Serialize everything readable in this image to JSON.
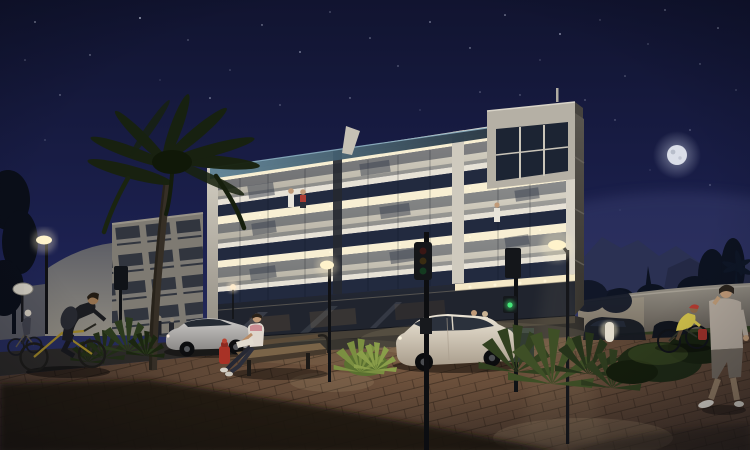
{
  "meta": {
    "type": "architectural-night-render",
    "description": "Night-time 3D visualization of a modern four-storey apartment building with brightly lit balconies above a glass commercial ground floor. A paved plaza in the foreground has a bench, fire hydrant, street lamps, traffic lights, palm tree, shrubs, two parked sedans, cyclists and pedestrians. Deep navy sky with stars and a full moon upper right.",
    "time_of_day": "night",
    "width": 750,
    "height": 450
  },
  "palette": {
    "sky_top": "#111430",
    "sky_mid": "#1c2150",
    "sky_horizon": "#303768",
    "moon": "#dadee8",
    "star": "#ccd2e6",
    "facade_white": "#e4dfd3",
    "lit_ceiling": "#f8efd3",
    "balcony_interior": "#d6d1c3",
    "navy_band": "#222a3f",
    "glass_dark": "#343b49",
    "storefront": "#20242e",
    "canopy_glow": "#f4e8c7",
    "roof_glass_light": "#5d8296",
    "roof_glass_dark": "#243442",
    "neighbor_wall": "#7e7a72",
    "left_wall": "#6a6b72",
    "right_wall": "#8f8a81",
    "mountain": "#2b3152",
    "tree_dark": "#0c1220",
    "palm_frond": "#18220f",
    "palm_trunk": "#362f26",
    "grass": "#3a4724",
    "shrub_dark": "#26331a",
    "shrub_lit": "#7b8f41",
    "paving_lit": "#74563f",
    "paving_dark": "#342820",
    "shadow": "#1f1710",
    "road": "#2b2927",
    "car_silver": "#b3b0ad",
    "car_white": "#e4dccd",
    "car_dark": "#141821",
    "lamp_glow": "#fff3cb",
    "light_pool": "#f6e0ae",
    "bench_wood": "#7a6448",
    "hydrant_red": "#a83226",
    "bike_yellow": "#9c8428",
    "shirt_yellow": "#cfbf4a",
    "cap_red": "#b23a30",
    "shirt_red": "#ac3c34",
    "shirt_white": "#e8e4da",
    "skin": "#c09a78",
    "signal_green": "#46e87a"
  },
  "scene": {
    "sky": {
      "moon": {
        "x": 677,
        "y": 155
      },
      "stars_visible": true
    },
    "main_building": {
      "storeys_above_ground": 3,
      "ground_floor": "glass commercial storefront with lit canopy",
      "balconies_lit": true,
      "roof": "glass balustrade and corner penthouse volume",
      "people_on_balconies": 3
    },
    "neighbor_building": {
      "position": "left",
      "balcony_rows": 4
    },
    "vehicles": [
      {
        "type": "sedan",
        "color": "silver",
        "position": "center-left, parked on road"
      },
      {
        "type": "sedan",
        "color": "white",
        "position": "center-right, in front of storefront"
      },
      {
        "type": "cars",
        "color": "dark",
        "position": "far right by perimeter wall"
      }
    ],
    "people": [
      "cyclist on yellow bicycle (foreground left)",
      "small cyclist (far left)",
      "person reading on bench",
      "two pedestrians by storefront",
      "couple beside white car",
      "couple on 3rd-floor balcony",
      "person on 2nd-floor balcony",
      "cyclist in yellow shirt with red cap (right)",
      "man walking at right edge"
    ],
    "street_objects": [
      "street-lamp-left",
      "street-lamp-center",
      "street-lamp-right",
      "traffic-light-foreground",
      "traffic-light-corner",
      "left-traffic-signal",
      "litter-bin",
      "bench",
      "fire-hydrant",
      "light-bollard",
      "round-luminaire-left"
    ],
    "vegetation": [
      "palm-tree-foreground",
      "palmetto-shrubs",
      "bright-lit-bush",
      "dark-bushes-right",
      "background-trees",
      "mountain-silhouette"
    ]
  },
  "stars": [
    [
      35,
      22,
      0.9
    ],
    [
      90,
      55,
      0.7
    ],
    [
      140,
      18,
      1.0
    ],
    [
      188,
      40,
      0.6
    ],
    [
      230,
      70,
      0.8
    ],
    [
      262,
      25,
      0.7
    ],
    [
      300,
      52,
      0.9
    ],
    [
      330,
      12,
      0.6
    ],
    [
      370,
      38,
      0.8
    ],
    [
      398,
      66,
      0.6
    ],
    [
      430,
      22,
      1.0
    ],
    [
      470,
      48,
      0.7
    ],
    [
      505,
      15,
      0.8
    ],
    [
      540,
      60,
      0.6
    ],
    [
      560,
      34,
      0.9
    ],
    [
      600,
      20,
      0.7
    ],
    [
      625,
      76,
      0.8
    ],
    [
      648,
      44,
      0.6
    ],
    [
      665,
      10,
      0.9
    ],
    [
      700,
      64,
      0.7
    ],
    [
      718,
      28,
      0.8
    ],
    [
      736,
      90,
      0.6
    ],
    [
      60,
      95,
      0.7
    ],
    [
      120,
      120,
      0.6
    ],
    [
      210,
      98,
      0.8
    ],
    [
      280,
      105,
      0.6
    ],
    [
      350,
      98,
      0.7
    ],
    [
      420,
      110,
      0.6
    ],
    [
      480,
      92,
      0.8
    ],
    [
      615,
      120,
      0.7
    ],
    [
      585,
      100,
      0.6
    ],
    [
      25,
      60,
      0.8
    ],
    [
      160,
      80,
      0.6
    ],
    [
      250,
      140,
      0.5
    ],
    [
      520,
      95,
      0.7
    ],
    [
      690,
      130,
      0.6
    ],
    [
      710,
      185,
      0.6
    ],
    [
      650,
      170,
      0.5
    ],
    [
      620,
      210,
      0.5
    ],
    [
      45,
      140,
      0.6
    ]
  ]
}
